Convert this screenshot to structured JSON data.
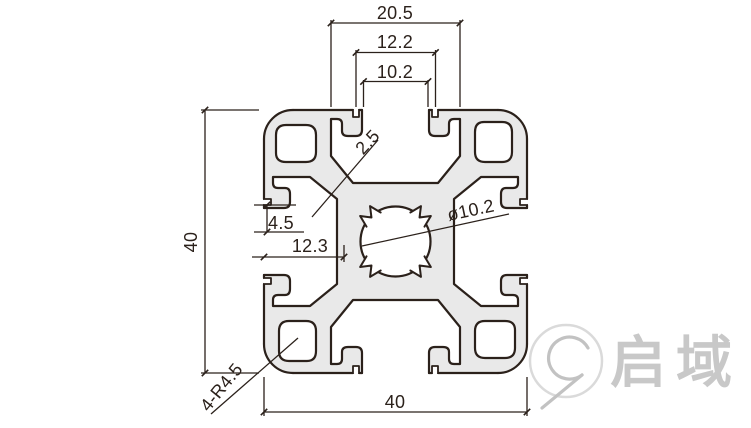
{
  "drawing": {
    "dimensions": {
      "slot_back_width": "20.5",
      "slot_groove_width": "12.2",
      "slot_opening_width": "10.2",
      "wall_thickness": "2.5",
      "bore_diameter": "ø10.2",
      "lip_depth": "4.5",
      "groove_depth": "12.3",
      "profile_height": "40",
      "profile_width": "40",
      "corner_radius": "4-R4.5"
    },
    "colors": {
      "line_color": "#2b211b",
      "profile_fill": "#e9e9e9",
      "logo_gray": "#c8c8c8"
    },
    "logo": {
      "text": "启域"
    }
  }
}
